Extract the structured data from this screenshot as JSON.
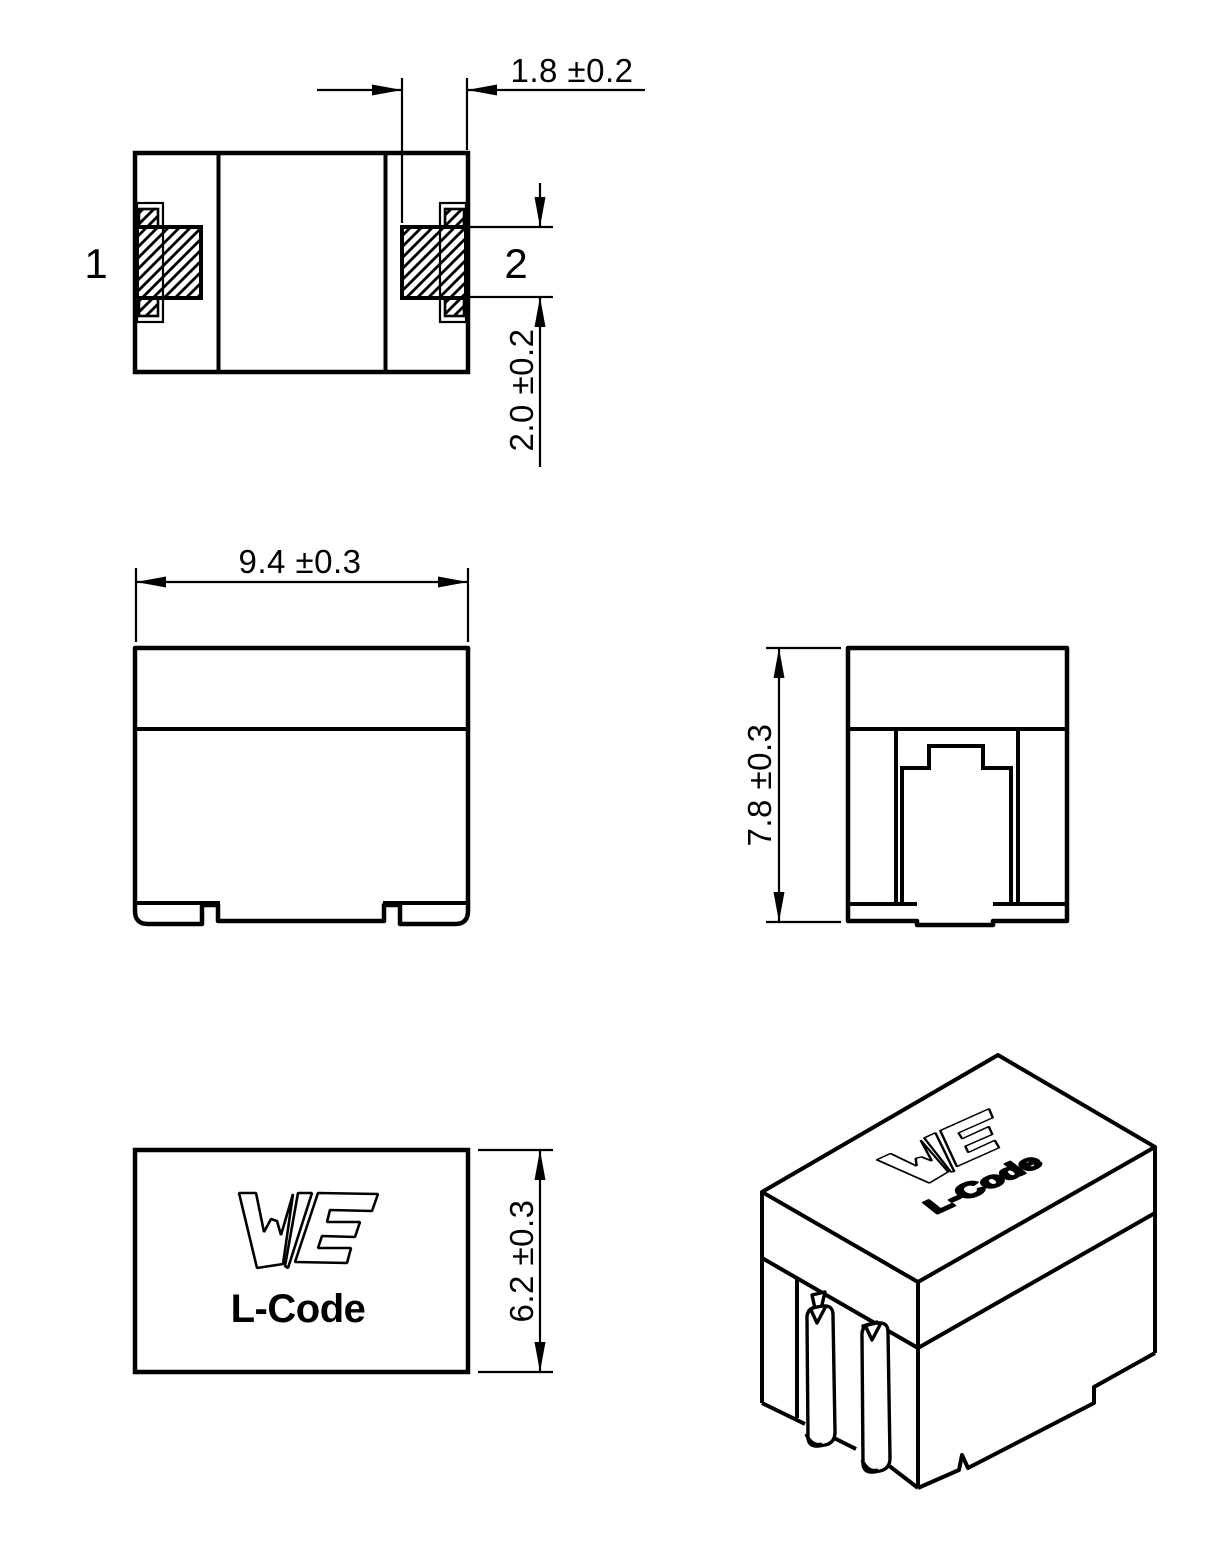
{
  "drawing": {
    "title": "inductor-dimension-drawing",
    "colors": {
      "line": "#000000",
      "background": "#ffffff"
    },
    "top_view": {
      "pin1_label": "1",
      "pin2_label": "2",
      "terminal_width_dim": "1.8 ±0.2",
      "terminal_height_dim": "2.0 ±0.2"
    },
    "front_view": {
      "width_dim": "9.4 ±0.3"
    },
    "side_view": {
      "height_dim": "7.8 ±0.3"
    },
    "marking_view": {
      "logo": "WE",
      "marking_text": "L-Code",
      "depth_dim": "6.2 ±0.3"
    },
    "iso_view": {
      "logo": "WE",
      "marking_text": "L-Code"
    }
  }
}
